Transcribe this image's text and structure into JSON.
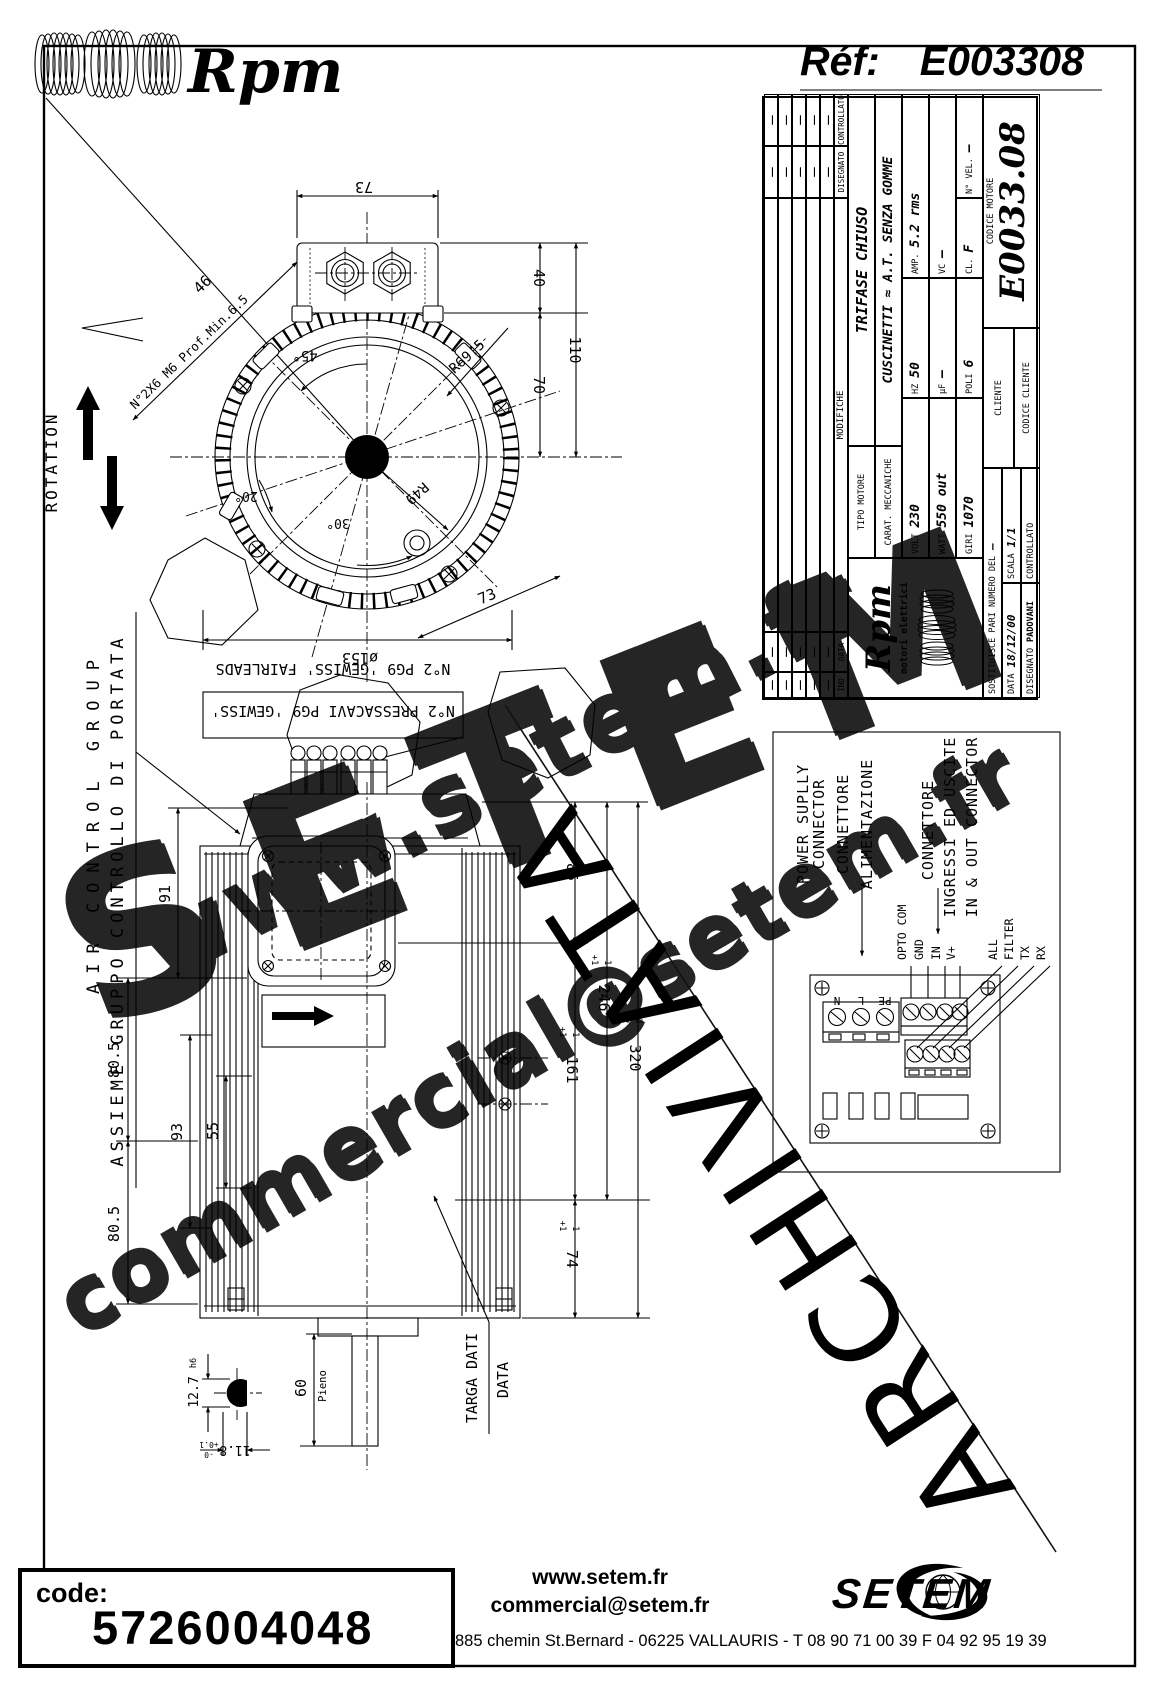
{
  "header": {
    "brand": "Rpm",
    "ref_label": "Réf:",
    "ref_value": "E003308"
  },
  "rotation_label": "ROTATION",
  "front": {
    "d73_top": "73",
    "d46": "46",
    "note_m6": "N°2X6 M6 Prof.Min.6.5",
    "d40": "40",
    "d110": "110",
    "d70": "70",
    "r695": "R69.5",
    "a45": "45°",
    "a20": "20°",
    "a30": "30°",
    "r49": "R49",
    "d73_diag": "73",
    "d153": "ø153"
  },
  "side": {
    "d91": "91",
    "d805a": "80.5",
    "d805b": "80.5",
    "d93": "93",
    "d55": "55",
    "d85": "85",
    "d246": "246",
    "d246p": "+1",
    "d246m": "-1",
    "d161": "161",
    "d161p": "+1",
    "d161m": "-1",
    "d320": "320",
    "d320p": "+2",
    "d320m": "-2",
    "d74": "74",
    "d74p": "+1",
    "d74m": "-1",
    "d60": "60",
    "pieno": "Pieno",
    "d127": "12.7",
    "d127t": "h6",
    "d118": "11.8",
    "d118p": "+0.1",
    "d118m": "-0",
    "targa1": "TARGA DATI",
    "targa2": "DATA",
    "fairleads": "N°2 PG9 'GEWISS' FAIRLEADS",
    "pressacavi": "N°2 PRESSACAVI PG9 'GEWISS'",
    "air_en": "AIR CONTROL GROUP",
    "air_it": "ASSIEME GRUPPO CONTROLLO DI PORTATA"
  },
  "connector": {
    "ps1": "POWER SUPLLY",
    "ps2": "CONNECTOR",
    "ps3": "CONNETTORE",
    "ps4": "ALIMENTAZIONE",
    "io1": "CONNETTORE",
    "io2": "INGRESSI ED USCITE",
    "io3": "IN & OUT CONNECTOR",
    "pins_power": [
      "PE",
      "L",
      "N"
    ],
    "pins_in": [
      "OPTO COM",
      "GND",
      "IN",
      "V+"
    ],
    "pins_out": [
      "ALL",
      "FILTER",
      "TX",
      "RX"
    ]
  },
  "titleblock": {
    "ind": "IND",
    "data": "DATA",
    "modifiche": "MODIFICHE",
    "disegnato": "DISEGNATO",
    "controllato": "CONTROLLATO",
    "dash": "–",
    "logo": "Rpm",
    "logo_sub": "motori elettrici",
    "tipo_label": "TIPO MOTORE",
    "tipo": "TRIFASE CHIUSO",
    "carat_label": "CARAT. MECCANICHE",
    "carat": "CUSCINETTI ≈ A.T. SENZA GOMME",
    "volt_label": "VOLT",
    "volt": "230",
    "hz_label": "HZ",
    "hz": "50",
    "amp_label": "AMP.",
    "amp": "5.2 rms",
    "watt_label": "WATT",
    "watt": "550 out",
    "uf_label": "μF",
    "uf": "–",
    "vc_label": "VC",
    "vc": "–",
    "giri_label": "GIRI",
    "giri": "1070",
    "poli_label": "POLI",
    "poli": "6",
    "cl_label": "CL.",
    "cl": "F",
    "nvel_label": "N° VEL.",
    "nvel": "–",
    "sost_label": "SOSTITUISCE PARI NUMERO DEL",
    "sost": "–",
    "data_label": "DATA",
    "data_value": "18/12/00",
    "scala_label": "SCALA",
    "scala": "1/1",
    "dis_label": "DISEGNATO",
    "dis": "PADOVANI",
    "con_label": "CONTROLLATO",
    "cliente_label": "CLIENTE",
    "codcli_label": "CODICE CLIENTE",
    "codmot_label": "CODICE MOTORE",
    "codmot": "E0033.08"
  },
  "watermark": {
    "site": "www.setem.fr",
    "name": "SETEM",
    "mail": "commercial@setem.fr",
    "stamp": "ARCHIVIATA"
  },
  "footer": {
    "code_label": "code:",
    "code": "5726004048",
    "site": "www.setem.fr",
    "email": "commercial@setem.fr",
    "address": "885 chemin St.Bernard  -  06225 VALLAURIS  -  T 08 90 71 00 39   F 04 92 95 19 39",
    "brand": "SETEM"
  }
}
